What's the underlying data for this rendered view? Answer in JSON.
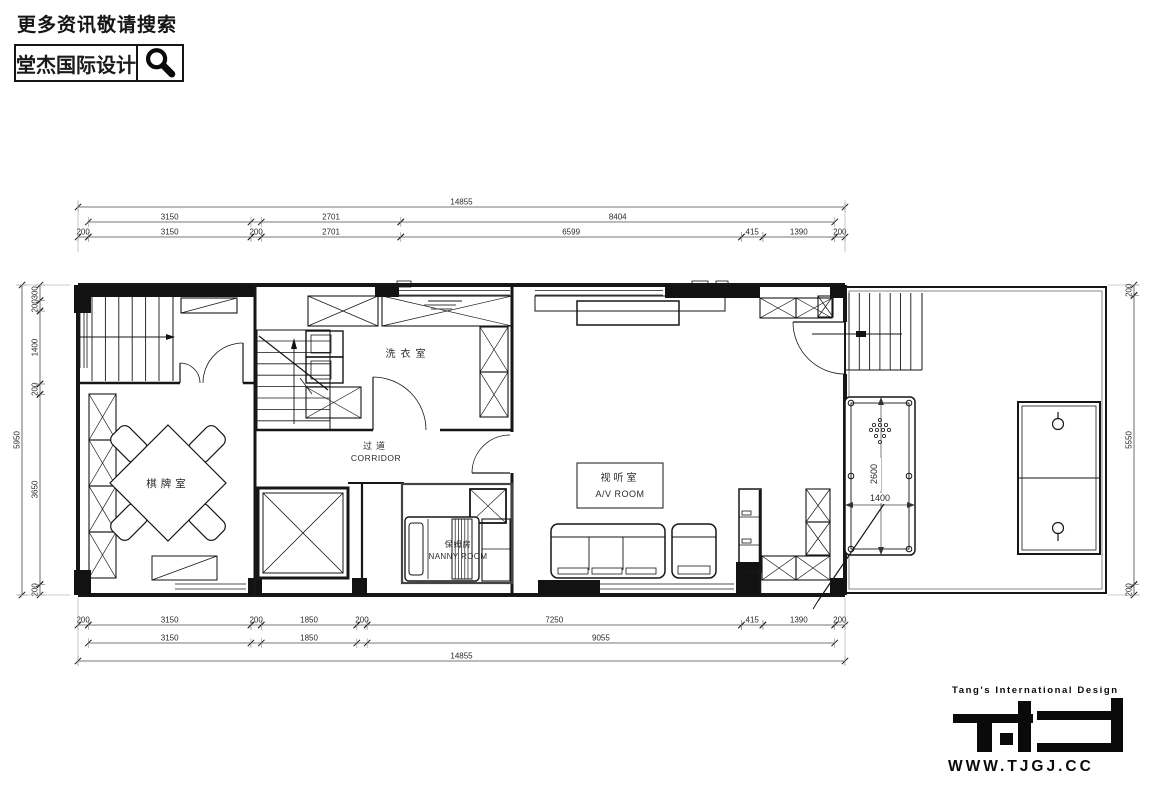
{
  "header": {
    "search_hint": "更多资讯敬请搜索",
    "brand": "堂杰国际设计"
  },
  "plan": {
    "rooms": {
      "chess_room": {
        "cn": "棋牌室"
      },
      "laundry_room": {
        "cn": "洗衣室"
      },
      "corridor": {
        "cn": "过道",
        "en": "CORRIDOR"
      },
      "nanny_room": {
        "cn": "保姆房",
        "en": "NANNY ROOM"
      },
      "av_room": {
        "cn": "视听室",
        "en": "A/V ROOM"
      }
    },
    "pool_table": {
      "length_mm": "2600",
      "width_mm": "1400"
    },
    "dims": {
      "top": [
        [
          {
            "a": 0,
            "b": 14855,
            "label": "14855"
          }
        ],
        [
          {
            "a": 200,
            "b": 3350,
            "label": "3150"
          },
          {
            "a": 3550,
            "b": 6251,
            "label": "2701"
          },
          {
            "a": 6251,
            "b": 14655,
            "label": "8404"
          }
        ],
        [
          {
            "a": 0,
            "b": 200,
            "label": "200"
          },
          {
            "a": 200,
            "b": 3350,
            "label": "3150"
          },
          {
            "a": 3350,
            "b": 3550,
            "label": "200"
          },
          {
            "a": 3550,
            "b": 6251,
            "label": "2701"
          },
          {
            "a": 6251,
            "b": 12850,
            "label": "6599"
          },
          {
            "a": 12850,
            "b": 13265,
            "label": "415"
          },
          {
            "a": 13265,
            "b": 14655,
            "label": "1390"
          },
          {
            "a": 14655,
            "b": 14855,
            "label": "200"
          }
        ]
      ],
      "bottom": [
        [
          {
            "a": 0,
            "b": 200,
            "label": "200"
          },
          {
            "a": 200,
            "b": 3350,
            "label": "3150"
          },
          {
            "a": 3350,
            "b": 3550,
            "label": "200"
          },
          {
            "a": 3550,
            "b": 5400,
            "label": "1850"
          },
          {
            "a": 5400,
            "b": 5600,
            "label": "200"
          },
          {
            "a": 5600,
            "b": 12850,
            "label": "7250"
          },
          {
            "a": 12850,
            "b": 13265,
            "label": "415"
          },
          {
            "a": 13265,
            "b": 14655,
            "label": "1390"
          },
          {
            "a": 14655,
            "b": 14855,
            "label": "200"
          }
        ],
        [
          {
            "a": 200,
            "b": 3350,
            "label": "3150"
          },
          {
            "a": 3550,
            "b": 5400,
            "label": "1850"
          },
          {
            "a": 5600,
            "b": 14655,
            "label": "9055"
          }
        ],
        [
          {
            "a": 0,
            "b": 14855,
            "label": "14855"
          }
        ]
      ],
      "left_outer": [
        [
          {
            "a": 0,
            "b": 5950,
            "label": "5950"
          }
        ]
      ],
      "left_inner": [
        [
          {
            "a": 0,
            "b": 300,
            "label": "300"
          },
          {
            "a": 300,
            "b": 500,
            "label": "200"
          },
          {
            "a": 500,
            "b": 1900,
            "label": "1400"
          },
          {
            "a": 1900,
            "b": 2100,
            "label": "200"
          },
          {
            "a": 2100,
            "b": 5750,
            "label": "3650"
          },
          {
            "a": 5750,
            "b": 5950,
            "label": "200"
          }
        ]
      ],
      "right": [
        [
          {
            "a": 0,
            "b": 200,
            "label": "200"
          },
          {
            "a": 200,
            "b": 5750,
            "label": "5550"
          },
          {
            "a": 5750,
            "b": 5950,
            "label": "200"
          }
        ]
      ]
    }
  },
  "footer": {
    "tagline": "Tang's International Design",
    "url": "WWW.TJGJ.CC"
  }
}
